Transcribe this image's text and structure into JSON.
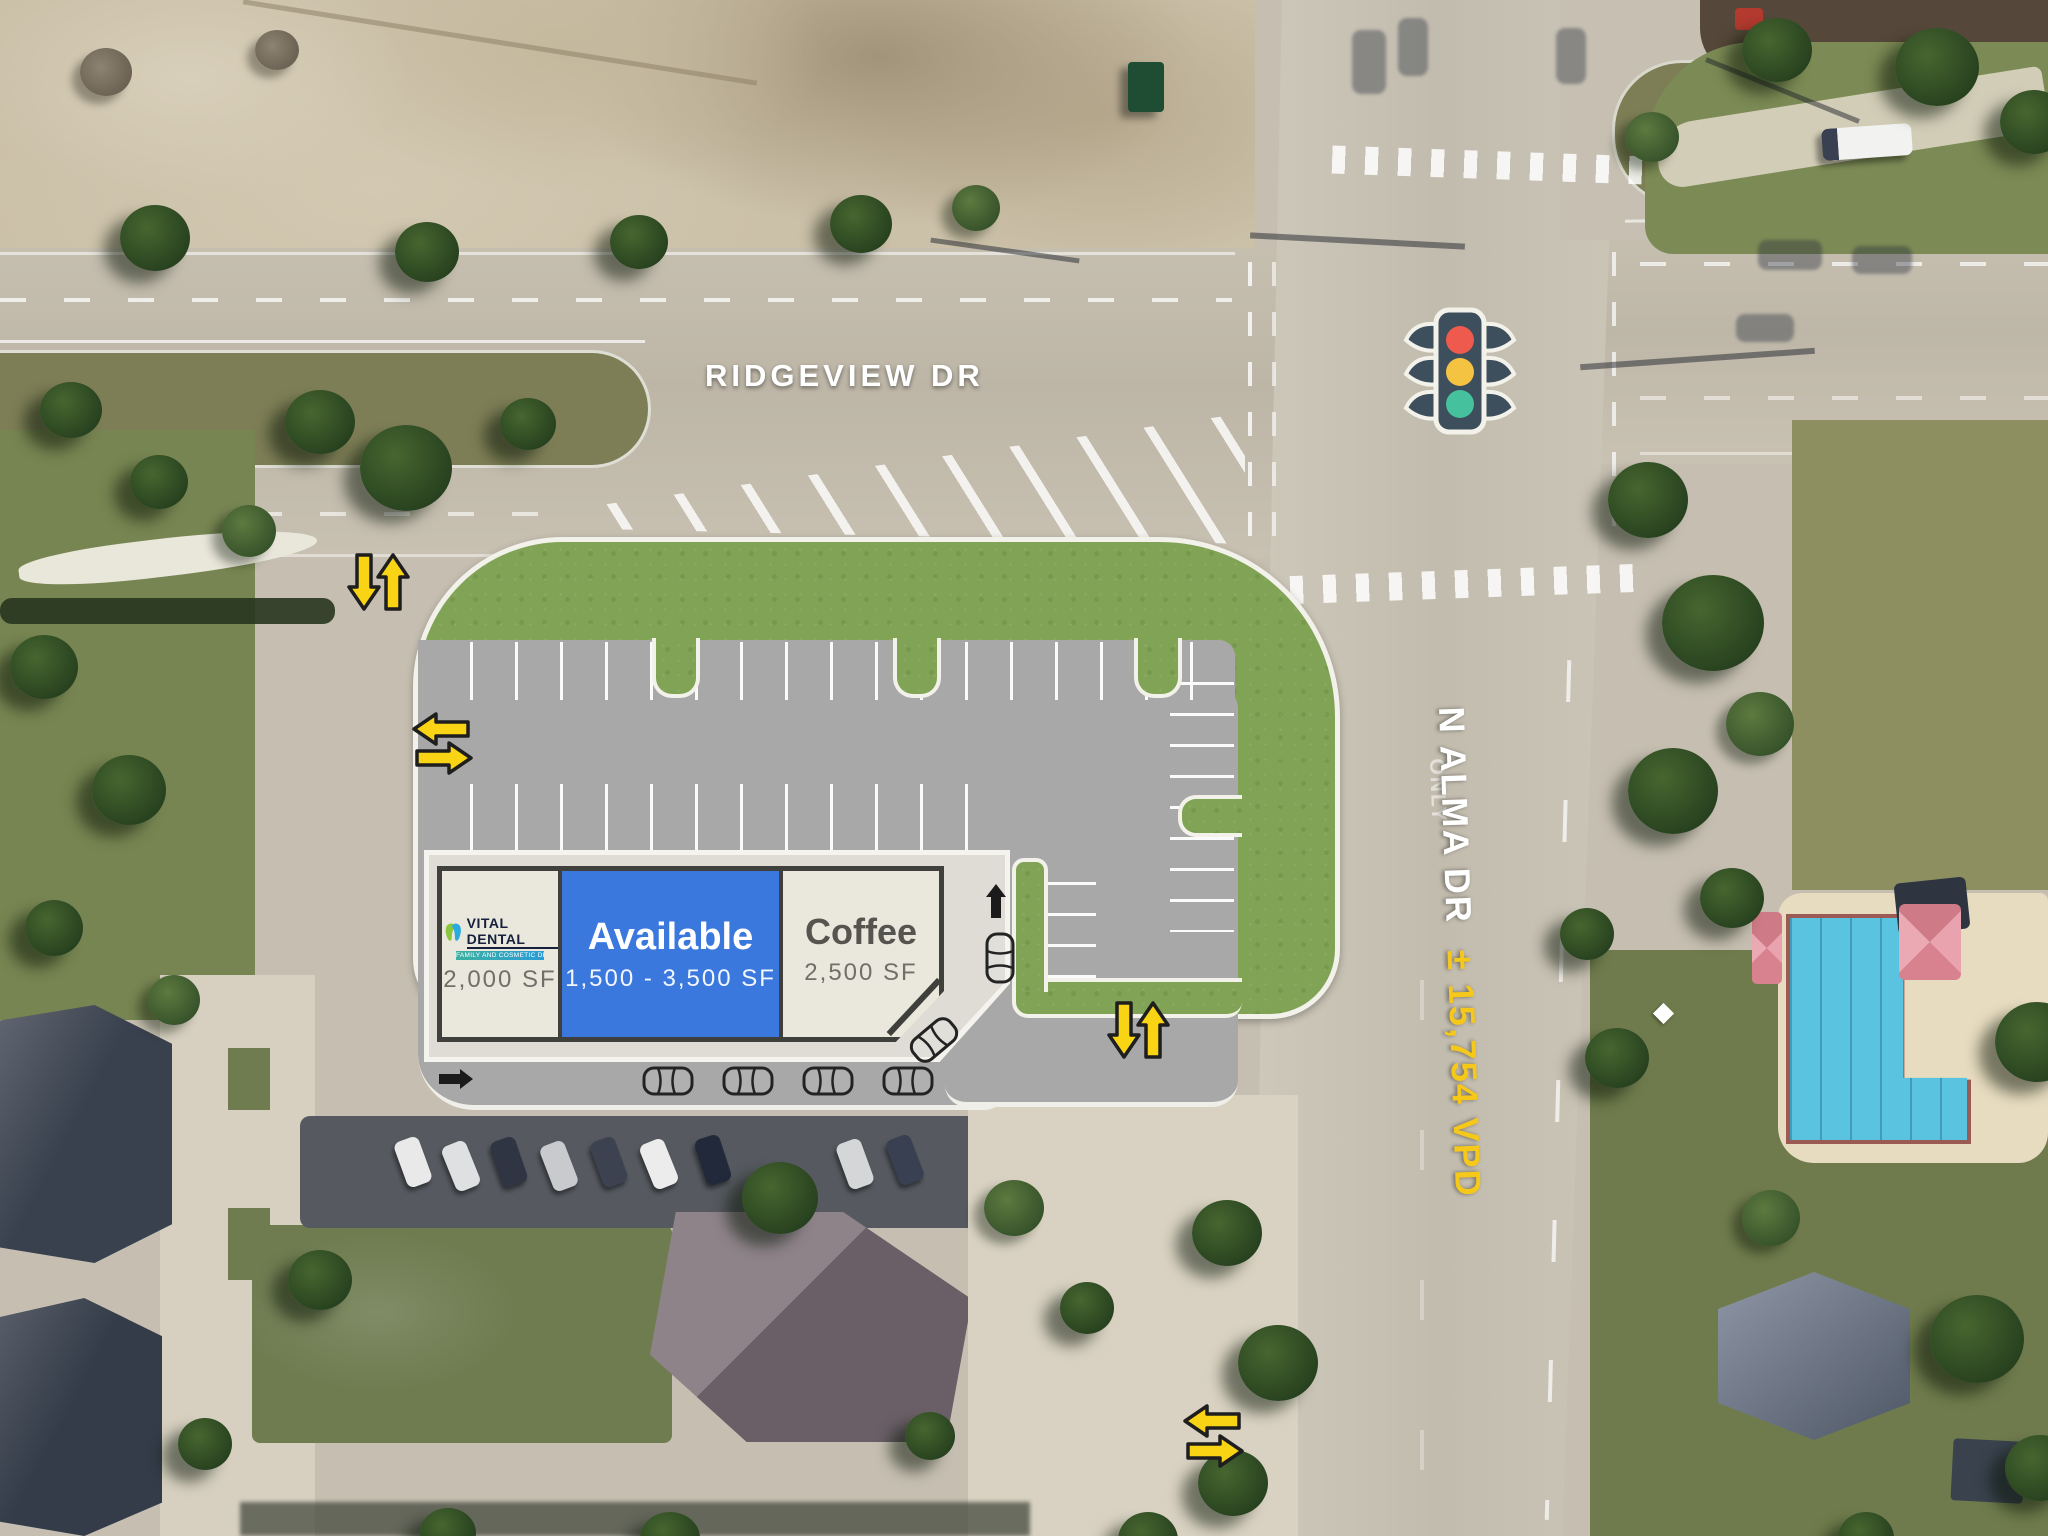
{
  "streets": {
    "ridgeview": {
      "label": "RIDGEVIEW DR"
    },
    "alma": {
      "label": "N ALMA DR",
      "traffic_count": "± 15,754 VPD"
    },
    "pavement_marking": "ONLY"
  },
  "building": {
    "units": [
      {
        "tenant": "VITAL DENTAL",
        "tagline": "FAMILY AND COSMETIC DENTISTRY",
        "size": "2,000 SF",
        "status": "leased",
        "panel_color": "#eae8dd"
      },
      {
        "tenant": "Available",
        "size": "1,500 - 3,500 SF",
        "status": "available",
        "panel_color": "#3a78dd"
      },
      {
        "tenant": "Coffee",
        "size": "2,500 SF",
        "status": "leased",
        "panel_color": "#eae8dd"
      }
    ]
  },
  "icons": {
    "traffic_light": "traffic-light at Ridgeview Dr & N Alma Dr",
    "yellow_access_arrows": [
      "two-way north-south at Ridgeview Dr driveway",
      "two-way east-west at west parking aisle",
      "two-way north-south at southeast parking aisle",
      "two-way east-west at south driveway"
    ],
    "black_flow_arrows": [
      "eastbound drive lane",
      "northbound drive-thru lane"
    ],
    "drive_lane_cars": 6
  },
  "colors": {
    "landscape_green": "#80a355",
    "parking_gray": "#a8a8a8",
    "available_blue": "#3a78dd",
    "arrow_yellow": "#f9d414",
    "vpd_yellow": "#f6c81a",
    "building_beige": "#eae8dd",
    "outline_dark": "#3f3f3c",
    "signal_red": "#ee5a4e",
    "signal_amber": "#f5c342",
    "signal_green": "#45c19d"
  }
}
